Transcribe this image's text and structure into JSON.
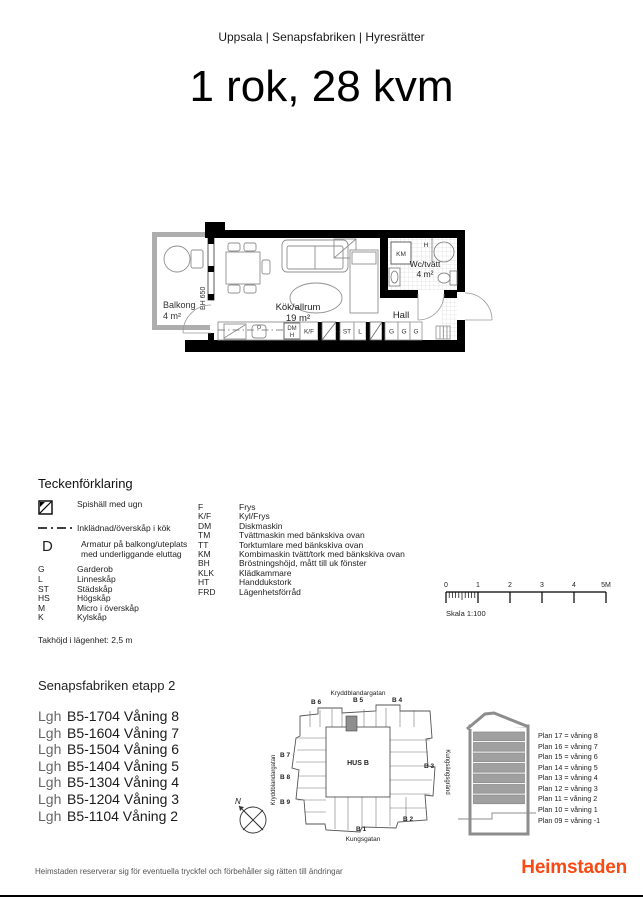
{
  "header": {
    "breadcrumb": "Uppsala | Senapsfabriken | Hyresrätter",
    "title": "1 rok, 28 kvm"
  },
  "floor_plan": {
    "balcony": "Balkong",
    "balcony_area": "4 m²",
    "bh": "BH 650",
    "kitchen": "Kök/allrum",
    "kitchen_area": "19 m²",
    "hall": "Hall",
    "wc": "Wc/tvätt",
    "wc_area": "4 m²",
    "km": "KM",
    "h": "H",
    "dm": "DM",
    "dm_h": "H",
    "kf": "K/F",
    "st": "ST",
    "l": "L",
    "g": "G"
  },
  "legend": {
    "heading": "Teckenförklaring",
    "symbols": [
      {
        "label": "Spishäll med ugn"
      },
      {
        "label": "Inklädnad/överskåp i kök"
      },
      {
        "label": "Armatur på balkong/uteplats med underliggande eluttag"
      }
    ],
    "d_glyph": "D",
    "abbr_left": [
      {
        "abbr": "G",
        "label": "Garderob"
      },
      {
        "abbr": "L",
        "label": "Linneskåp"
      },
      {
        "abbr": "ST",
        "label": "Städskåp"
      },
      {
        "abbr": "HS",
        "label": "Högskåp"
      },
      {
        "abbr": "M",
        "label": "Micro i överskåp"
      },
      {
        "abbr": "K",
        "label": "Kylskåp"
      }
    ],
    "abbr_right": [
      {
        "abbr": "F",
        "label": "Frys"
      },
      {
        "abbr": "K/F",
        "label": "Kyl/Frys"
      },
      {
        "abbr": "DM",
        "label": "Diskmaskin"
      },
      {
        "abbr": "TM",
        "label": "Tvättmaskin med bänkskiva ovan"
      },
      {
        "abbr": "TT",
        "label": "Torktumlare med bänkskiva ovan"
      },
      {
        "abbr": "KM",
        "label": "Kombimaskin tvätt/tork med bänkskiva ovan"
      },
      {
        "abbr": "BH",
        "label": "Bröstningshöjd, mått till uk fönster"
      },
      {
        "abbr": "KLK",
        "label": "Klädkammare"
      },
      {
        "abbr": "HT",
        "label": "Handdukstork"
      },
      {
        "abbr": "FRD",
        "label": "Lägenhetsförråd"
      }
    ],
    "ceiling_note": "Takhöjd i lägenhet: 2,5 m"
  },
  "scale": {
    "ticks": [
      "0",
      "1",
      "2",
      "3",
      "4",
      "5M"
    ],
    "label": "Skala 1:100"
  },
  "apartments": {
    "heading": "Senapsfabriken etapp 2",
    "items": [
      {
        "prefix": "Lgh",
        "label": "B5-1704 Våning 8"
      },
      {
        "prefix": "Lgh",
        "label": "B5-1604 Våning 7"
      },
      {
        "prefix": "Lgh",
        "label": "B5-1504 Våning 6"
      },
      {
        "prefix": "Lgh",
        "label": "B5-1404 Våning 5"
      },
      {
        "prefix": "Lgh",
        "label": "B5-1304 Våning 4"
      },
      {
        "prefix": "Lgh",
        "label": "B5-1204 Våning 3"
      },
      {
        "prefix": "Lgh",
        "label": "B5-1104 Våning 2"
      }
    ]
  },
  "site_plan": {
    "street_top": "Kryddblandargatan",
    "street_left": "Kryddblandargatan",
    "street_right": "Kungsängsgränd",
    "street_bottom": "Kungsgatan",
    "building": "HUS B",
    "compass": "N",
    "entrances": [
      "B 6",
      "B 5",
      "B 4",
      "B 7",
      "B 8",
      "B 9",
      "B 3",
      "B 2",
      "B 1"
    ],
    "highlight_color": "#8e8e8e"
  },
  "section": {
    "floors": [
      "Plan 17 = våning 8",
      "Plan 16 = våning 7",
      "Plan 15 = våning 6",
      "Plan 14 = våning 5",
      "Plan 13 = våning 4",
      "Plan 12 = våning 3",
      "Plan 11 = våning 2",
      "Plan 10 = våning 1",
      "Plan 09 = våning -1"
    ],
    "floor_fill": "#a0a0a0"
  },
  "footer": {
    "disclaimer": "Heimstaden reserverar sig för eventuella tryckfel och förbehåller sig rätten till ändringar",
    "brand": "Heimstaden",
    "brand_color": "#f84a14"
  }
}
